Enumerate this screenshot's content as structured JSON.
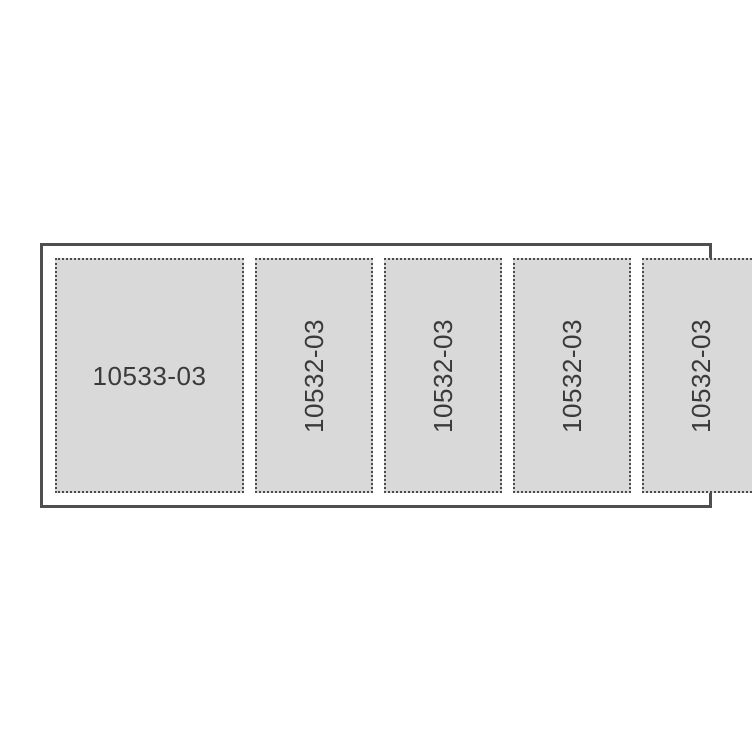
{
  "diagram": {
    "outer_border_color": "#4f4f4f",
    "panel_fill_color": "#d9d9d9",
    "panel_border_color": "#4a4a4a",
    "label_color": "#3a3a3a",
    "panels": [
      {
        "label": "10533-03",
        "orientation": "horizontal"
      },
      {
        "label": "10532-03",
        "orientation": "vertical"
      },
      {
        "label": "10532-03",
        "orientation": "vertical"
      },
      {
        "label": "10532-03",
        "orientation": "vertical"
      },
      {
        "label": "10532-03",
        "orientation": "vertical"
      }
    ]
  }
}
